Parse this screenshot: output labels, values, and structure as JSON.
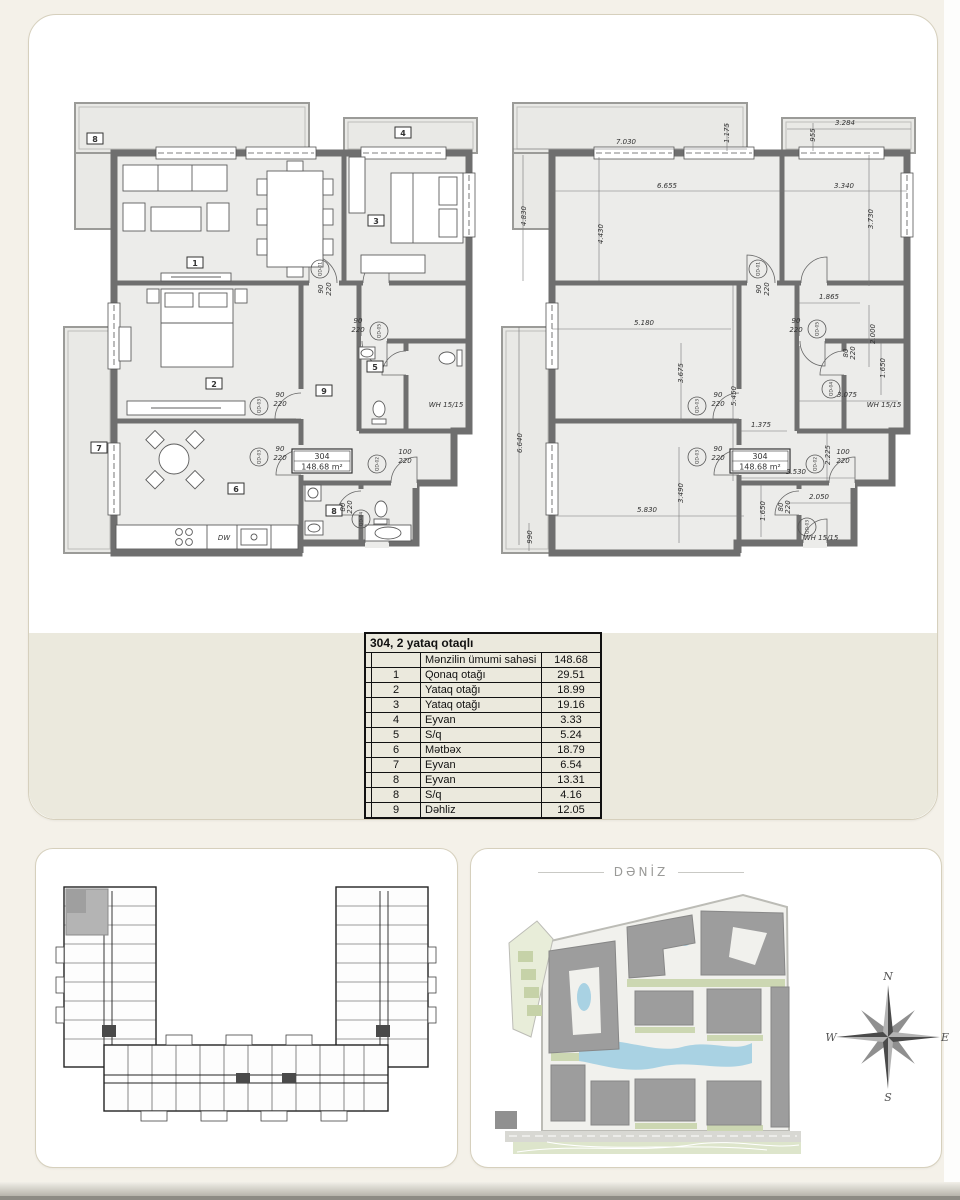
{
  "unit": {
    "number": "304",
    "area": "148.68 m²"
  },
  "table": {
    "title": "304, 2 yataq otaqlı",
    "header": {
      "label": "Mənzilin ümumi sahəsi",
      "value": "148.68"
    },
    "rows": [
      {
        "num": "1",
        "name": "Qonaq otağı",
        "value": "29.51"
      },
      {
        "num": "2",
        "name": "Yataq otağı",
        "value": "18.99"
      },
      {
        "num": "3",
        "name": "Yataq otağı",
        "value": "19.16"
      },
      {
        "num": "4",
        "name": "Eyvan",
        "value": "3.33"
      },
      {
        "num": "5",
        "name": "S/q",
        "value": "5.24"
      },
      {
        "num": "6",
        "name": "Mətbəx",
        "value": "18.79"
      },
      {
        "num": "7",
        "name": "Eyvan",
        "value": "6.54"
      },
      {
        "num": "8",
        "name": "Eyvan",
        "value": "13.31"
      },
      {
        "num": "8",
        "name": "S/q",
        "value": "4.16"
      },
      {
        "num": "9",
        "name": "Dəhliz",
        "value": "12.05"
      }
    ]
  },
  "site": {
    "sea_label": "DƏNİZ",
    "compass": {
      "n": "N",
      "e": "E",
      "s": "S",
      "w": "W"
    }
  },
  "colors": {
    "page_bg": "#f4f1e9",
    "band": "#ebe9dd",
    "wall": "#6f6f6f",
    "water": "#a9d2e3",
    "building": "#9d9d9d",
    "green": "#ccd7b2"
  },
  "plans": {
    "left": {
      "rooms": [
        {
          "t": "8",
          "x": 34,
          "y": 50,
          "box": true
        },
        {
          "t": "4",
          "x": 342,
          "y": 44,
          "box": true
        },
        {
          "t": "1",
          "x": 134,
          "y": 174,
          "box": true
        },
        {
          "t": "3",
          "x": 315,
          "y": 132,
          "box": true
        },
        {
          "t": "2",
          "x": 153,
          "y": 295,
          "box": true
        },
        {
          "t": "9",
          "x": 263,
          "y": 302,
          "box": true
        },
        {
          "t": "5",
          "x": 314,
          "y": 278,
          "box": true
        },
        {
          "t": "7",
          "x": 38,
          "y": 359,
          "box": true
        },
        {
          "t": "6",
          "x": 175,
          "y": 400,
          "box": true
        },
        {
          "t": "8",
          "x": 273,
          "y": 422,
          "box": true
        }
      ],
      "doors": [
        {
          "t": "QD-01",
          "x": 259,
          "y": 178
        },
        {
          "t": "QD-05",
          "x": 318,
          "y": 240
        },
        {
          "t": "QD-03",
          "x": 198,
          "y": 315
        },
        {
          "t": "QD-03",
          "x": 198,
          "y": 366
        },
        {
          "t": "QD-02",
          "x": 316,
          "y": 373
        },
        {
          "t": "QD-04",
          "x": 300,
          "y": 428
        }
      ],
      "dims": [
        {
          "t": "90",
          "x": 219,
          "y": 306,
          "fs": 6
        },
        {
          "t": "220",
          "x": 219,
          "y": 315,
          "fs": 6
        },
        {
          "t": "90",
          "x": 219,
          "y": 360,
          "fs": 6
        },
        {
          "t": "220",
          "x": 219,
          "y": 369,
          "fs": 6
        },
        {
          "t": "90",
          "x": 262,
          "y": 198,
          "fs": 6,
          "r": -90
        },
        {
          "t": "220",
          "x": 270,
          "y": 198,
          "fs": 6,
          "r": -90
        },
        {
          "t": "90",
          "x": 297,
          "y": 232,
          "fs": 6
        },
        {
          "t": "220",
          "x": 297,
          "y": 241,
          "fs": 6
        },
        {
          "t": "100",
          "x": 344,
          "y": 363,
          "fs": 6
        },
        {
          "t": "220",
          "x": 344,
          "y": 372,
          "fs": 6
        },
        {
          "t": "80",
          "x": 284,
          "y": 416,
          "fs": 6,
          "r": -90
        },
        {
          "t": "220",
          "x": 291,
          "y": 416,
          "fs": 6,
          "r": -90
        },
        {
          "t": "DW",
          "x": 163,
          "y": 449,
          "fs": 5
        },
        {
          "t": "WH 15/15",
          "x": 385,
          "y": 316,
          "fs": 4
        }
      ]
    },
    "right": {
      "doors": [
        {
          "t": "QD-01",
          "x": 259,
          "y": 178
        },
        {
          "t": "QD-05",
          "x": 318,
          "y": 238
        },
        {
          "t": "QD-04",
          "x": 332,
          "y": 298
        },
        {
          "t": "QD-03",
          "x": 198,
          "y": 315
        },
        {
          "t": "QD-03",
          "x": 198,
          "y": 366
        },
        {
          "t": "QD-02",
          "x": 316,
          "y": 373
        },
        {
          "t": "QD-03",
          "x": 308,
          "y": 436
        }
      ],
      "dims": [
        {
          "t": "7.030",
          "x": 127,
          "y": 53
        },
        {
          "t": "1.175",
          "x": 230,
          "y": 42,
          "r": -90
        },
        {
          "t": "955",
          "x": 316,
          "y": 44,
          "r": -90
        },
        {
          "t": "3.284",
          "x": 346,
          "y": 34
        },
        {
          "t": "4.830",
          "x": 27,
          "y": 125,
          "r": -90
        },
        {
          "t": "6.655",
          "x": 168,
          "y": 97
        },
        {
          "t": "3.340",
          "x": 345,
          "y": 97
        },
        {
          "t": "4.430",
          "x": 104,
          "y": 143,
          "r": -90
        },
        {
          "t": "3.730",
          "x": 374,
          "y": 128,
          "r": -90
        },
        {
          "t": "1.865",
          "x": 330,
          "y": 208
        },
        {
          "t": "2.000",
          "x": 376,
          "y": 243,
          "r": -90
        },
        {
          "t": "5.180",
          "x": 145,
          "y": 234
        },
        {
          "t": "3.675",
          "x": 184,
          "y": 282,
          "r": -90
        },
        {
          "t": "5.450",
          "x": 237,
          "y": 305,
          "r": -90
        },
        {
          "t": "1.375",
          "x": 262,
          "y": 336
        },
        {
          "t": "1.650",
          "x": 386,
          "y": 277,
          "r": -90
        },
        {
          "t": "3.075",
          "x": 348,
          "y": 306
        },
        {
          "t": "6.640",
          "x": 23,
          "y": 352,
          "r": -90
        },
        {
          "t": "3.490",
          "x": 184,
          "y": 402,
          "r": -90
        },
        {
          "t": "5.830",
          "x": 148,
          "y": 421
        },
        {
          "t": "990",
          "x": 33,
          "y": 446,
          "r": -90
        },
        {
          "t": "2.225",
          "x": 331,
          "y": 364,
          "r": -90
        },
        {
          "t": "3.530",
          "x": 297,
          "y": 383
        },
        {
          "t": "2.050",
          "x": 320,
          "y": 408
        },
        {
          "t": "1.650",
          "x": 266,
          "y": 420,
          "r": -90
        },
        {
          "t": "90",
          "x": 262,
          "y": 198,
          "fs": 6,
          "r": -90
        },
        {
          "t": "220",
          "x": 270,
          "y": 198,
          "fs": 6,
          "r": -90
        },
        {
          "t": "90",
          "x": 297,
          "y": 232,
          "fs": 6
        },
        {
          "t": "220",
          "x": 297,
          "y": 241,
          "fs": 6
        },
        {
          "t": "90",
          "x": 219,
          "y": 306,
          "fs": 6
        },
        {
          "t": "220",
          "x": 219,
          "y": 315,
          "fs": 6
        },
        {
          "t": "90",
          "x": 219,
          "y": 360,
          "fs": 6
        },
        {
          "t": "220",
          "x": 219,
          "y": 369,
          "fs": 6
        },
        {
          "t": "100",
          "x": 344,
          "y": 363,
          "fs": 6
        },
        {
          "t": "220",
          "x": 344,
          "y": 372,
          "fs": 6
        },
        {
          "t": "80",
          "x": 349,
          "y": 262,
          "fs": 6,
          "r": -90
        },
        {
          "t": "220",
          "x": 356,
          "y": 262,
          "fs": 6,
          "r": -90
        },
        {
          "t": "80",
          "x": 284,
          "y": 416,
          "fs": 6,
          "r": -90
        },
        {
          "t": "220",
          "x": 291,
          "y": 416,
          "fs": 6,
          "r": -90
        },
        {
          "t": "WH 15/15",
          "x": 385,
          "y": 316,
          "fs": 4
        },
        {
          "t": "WH 15/15",
          "x": 322,
          "y": 449,
          "fs": 4
        }
      ]
    }
  }
}
